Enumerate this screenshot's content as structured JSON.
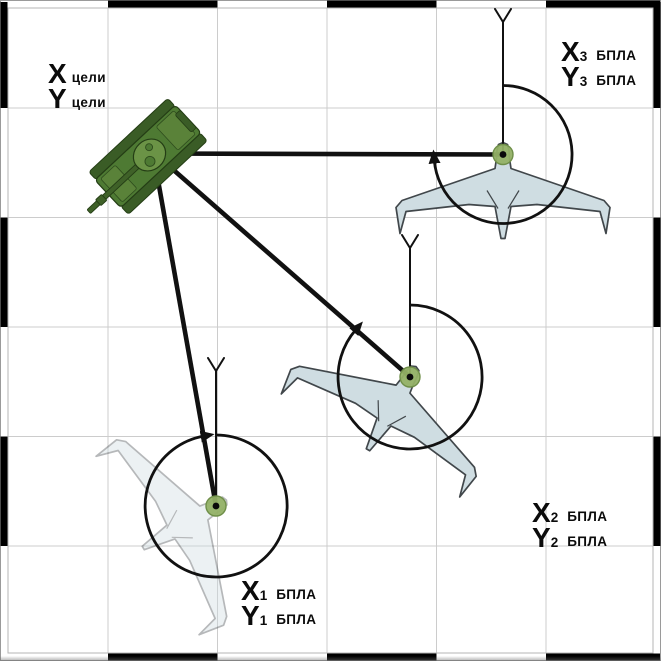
{
  "labels": {
    "target": {
      "row1": {
        "letter": "X",
        "word": "цели"
      },
      "row2": {
        "letter": "Y",
        "word": "цели"
      }
    },
    "uav3": {
      "row1": {
        "letter": "X",
        "sub": "3",
        "word": "БПЛА"
      },
      "row2": {
        "letter": "Y",
        "sub": "3",
        "word": "БПЛА"
      }
    },
    "uav2": {
      "row1": {
        "letter": "X",
        "sub": "2",
        "word": "БПЛА"
      },
      "row2": {
        "letter": "Y",
        "sub": "2",
        "word": "БПЛА"
      }
    },
    "uav1": {
      "row1": {
        "letter": "X",
        "sub": "1",
        "word": "БПЛА"
      },
      "row2": {
        "letter": "Y",
        "sub": "1",
        "word": "БПЛА"
      }
    }
  },
  "icons": {
    "tank-icon": "green tank top view, gun pointing south-west",
    "uav-icon": "flying-wing drone silhouette, nose at green dot",
    "north-antenna-icon": "vertical line with Y fork marking north axis",
    "bearing-arc-icon": "clockwise arc with arrowhead from north to line-of-sight",
    "waypoint-dot-icon": "green circle with black center"
  },
  "colors": {
    "bg": "#ffffff",
    "grid_gray": "#cccccc",
    "frame_black": "#000000",
    "line_black": "#111111",
    "uav_fill": "#cfdde2",
    "uav_outline": "#41474b",
    "dot_fill": "#94b166",
    "dot_ring": "#6f8f49",
    "tank_green": "#4e7a33",
    "tank_green_dark": "#3a5c26",
    "tank_deck": "#5a8239",
    "turret_green": "#6b9346",
    "tank_outline": "#243d15"
  }
}
